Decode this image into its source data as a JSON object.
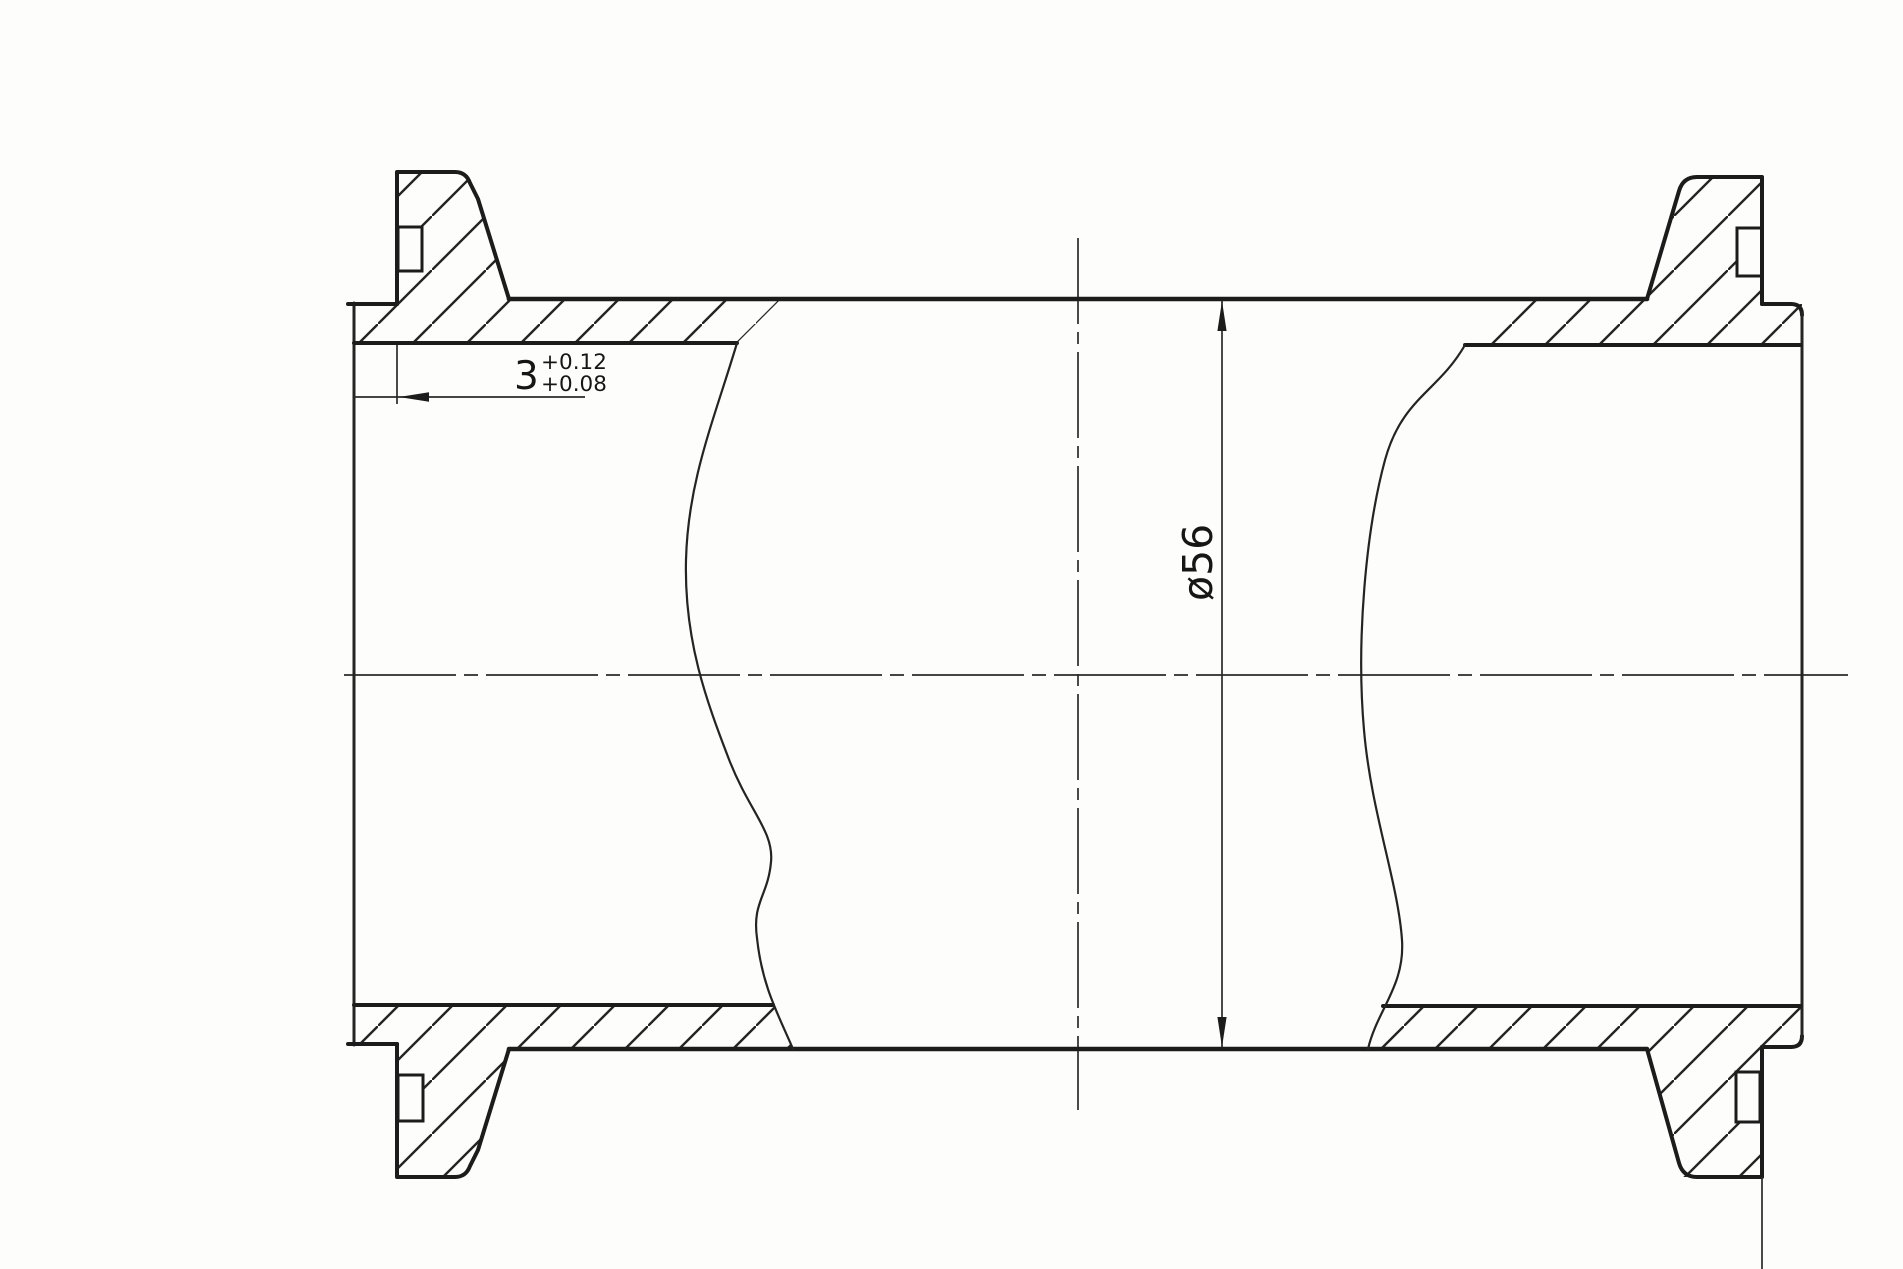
{
  "drawing": {
    "title": "clamp-ferrule pipe spool section",
    "dim_groove_depth": {
      "value": "3",
      "tol_upper": "+0.12",
      "tol_lower": "+0.08"
    },
    "dim_diameter": {
      "label": "ø56"
    }
  },
  "colors": {
    "ink": "#1c1c1c",
    "paper": "#fdfdfc"
  }
}
